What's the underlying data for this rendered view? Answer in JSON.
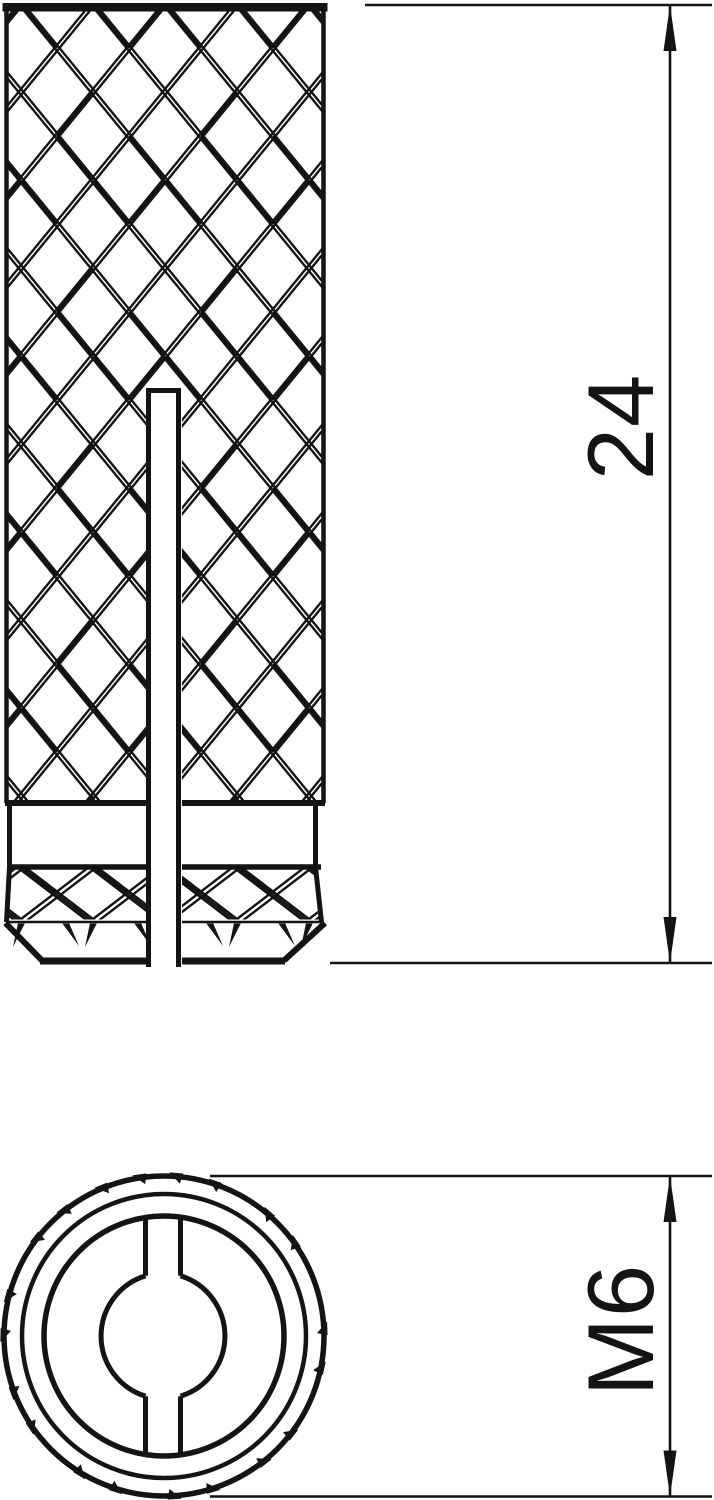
{
  "page": {
    "background_color": "#ffffff"
  },
  "drawing": {
    "line_color": "#141414",
    "dimensions": {
      "overall_length": {
        "label": "24"
      },
      "thread_size": {
        "label": "M6"
      }
    }
  }
}
